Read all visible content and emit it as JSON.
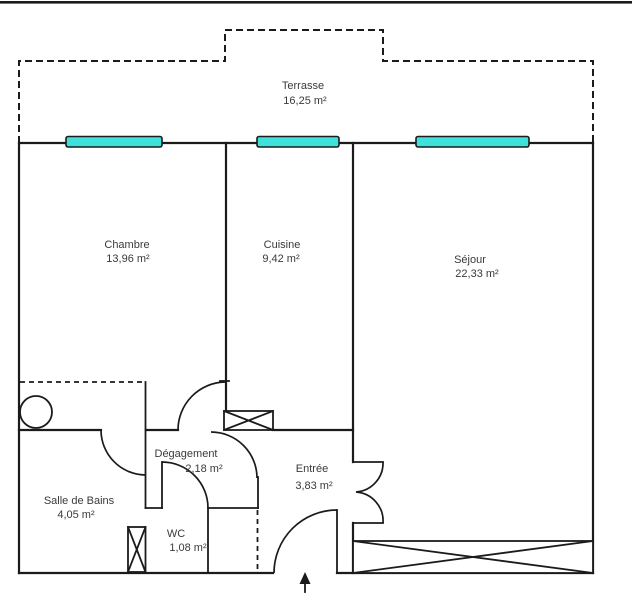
{
  "plan": {
    "title": "Plan d'appartement",
    "rooms": {
      "terrasse": {
        "name": "Terrasse",
        "area": "16,25  m²"
      },
      "chambre": {
        "name": "Chambre",
        "area": "13,96  m²"
      },
      "cuisine": {
        "name": "Cuisine",
        "area": "9,42  m²"
      },
      "sejour": {
        "name": "Séjour",
        "area": "22,33  m²"
      },
      "salle_de_bains": {
        "name": "Salle de Bains",
        "area": "4,05  m²"
      },
      "degagement": {
        "name": "Dégagement",
        "area": "2,18  m²"
      },
      "wc": {
        "name": "WC",
        "area": "1,08  m²"
      },
      "entree": {
        "name": "Entrée",
        "area": "3,83  m²"
      }
    },
    "colors": {
      "line": "#1b1b1b",
      "text": "#3a3a3a",
      "window_fill": "#3EE1DC",
      "background": "#ffffff"
    }
  }
}
